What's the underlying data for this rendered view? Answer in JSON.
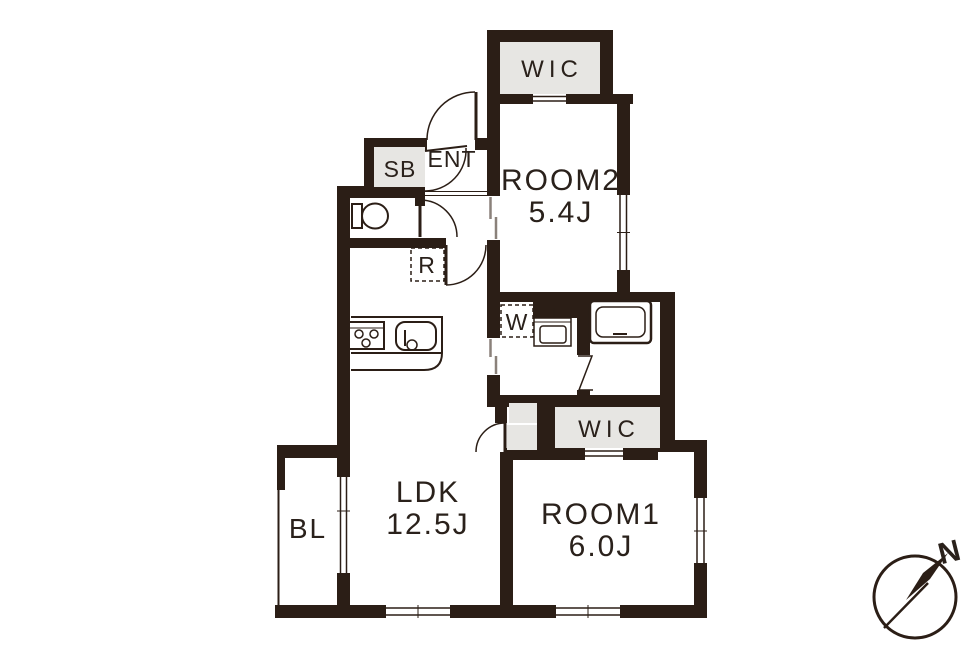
{
  "floorplan": {
    "colors": {
      "wall": "#2b1e16",
      "area_fill": "#e7e6e3",
      "background": "#ffffff",
      "slider_line": "#8a817a"
    },
    "labels": {
      "wic_top": "WIC",
      "room2_name": "ROOM2",
      "room2_size": "5.4J",
      "shoe_box": "SB",
      "entrance": "ENT",
      "refrigerator": "R",
      "washer": "W",
      "wic_mid": "WIC",
      "ldk_name": "LDK",
      "ldk_size": "12.5J",
      "room1_name": "ROOM1",
      "room1_size": "6.0J",
      "balcony": "BL",
      "compass_north": "N"
    }
  }
}
